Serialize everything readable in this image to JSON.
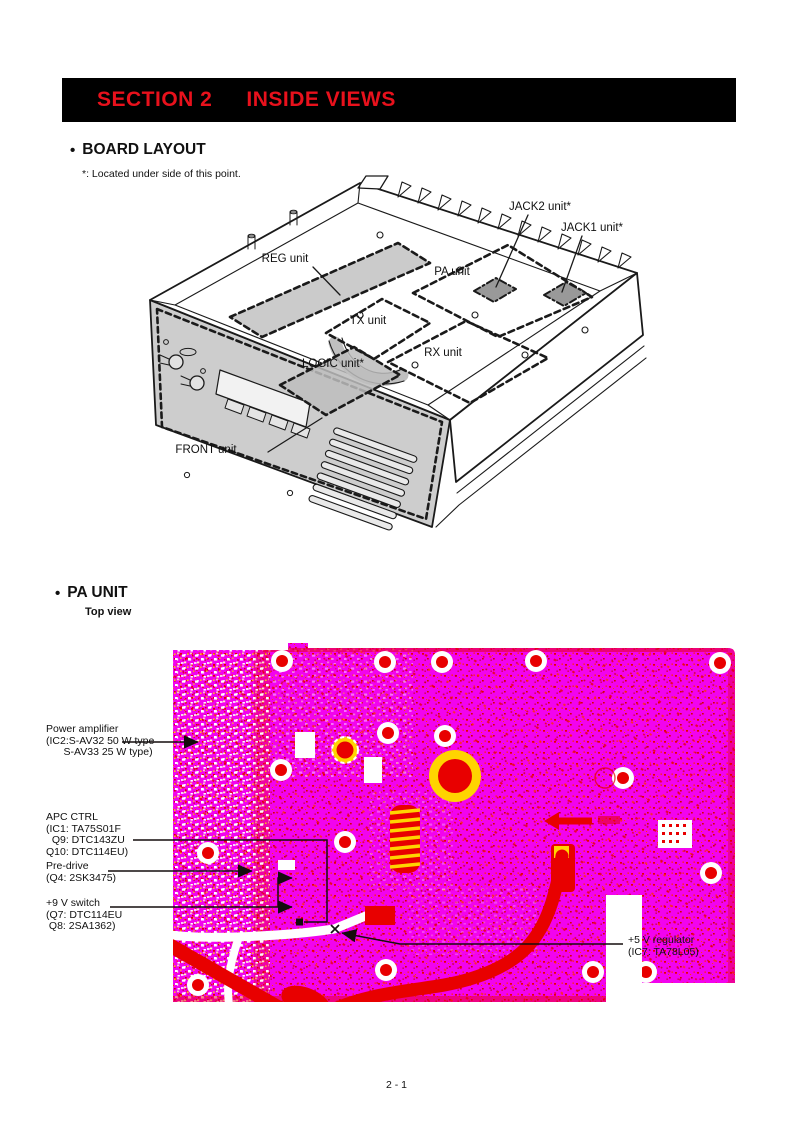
{
  "colors": {
    "header_bg": "#000000",
    "header_text": "#e8111c",
    "pcb_magenta": "#f203ee",
    "pcb_red": "#e80000",
    "pcb_yellow": "#ffd400",
    "shade_gray": "#cbcbcb",
    "jack_pad_gray": "#999999"
  },
  "header": {
    "section": "SECTION 2",
    "title": "INSIDE VIEWS"
  },
  "board_layout": {
    "bullet": "•",
    "heading": "BOARD LAYOUT",
    "note": "*: Located under side of this point.",
    "units": {
      "reg": "REG unit",
      "pa": "PA unit",
      "tx": "TX unit",
      "rx": "RX unit",
      "logic": "LOGIC unit*",
      "front": "FRONT unit",
      "jack2": "JACK2 unit*",
      "jack1": "JACK1 unit*"
    }
  },
  "pa_unit": {
    "bullet": "•",
    "heading": "PA UNIT",
    "subheading": "Top view",
    "callouts": {
      "power_amplifier": {
        "lines": [
          "Power amplifier",
          "(IC2:S-AV32 50 W type",
          "      S-AV33 25 W type)"
        ]
      },
      "apc_ctrl": {
        "lines": [
          "APC CTRL",
          "(IC1: TA75S01F",
          "  Q9: DTC143ZU",
          "Q10: DTC114EU)"
        ]
      },
      "pre_drive": {
        "lines": [
          "Pre-drive",
          "(Q4: 2SK3475)"
        ]
      },
      "nine_v_switch": {
        "lines": [
          "+9 V switch",
          "(Q7: DTC114EU",
          " Q8: 2SA1362)"
        ]
      },
      "five_v_regulator": {
        "lines": [
          "+5 V regulator",
          "(IC7: TA78L05)"
        ]
      }
    }
  },
  "footer": {
    "page_number": "2 - 1"
  }
}
